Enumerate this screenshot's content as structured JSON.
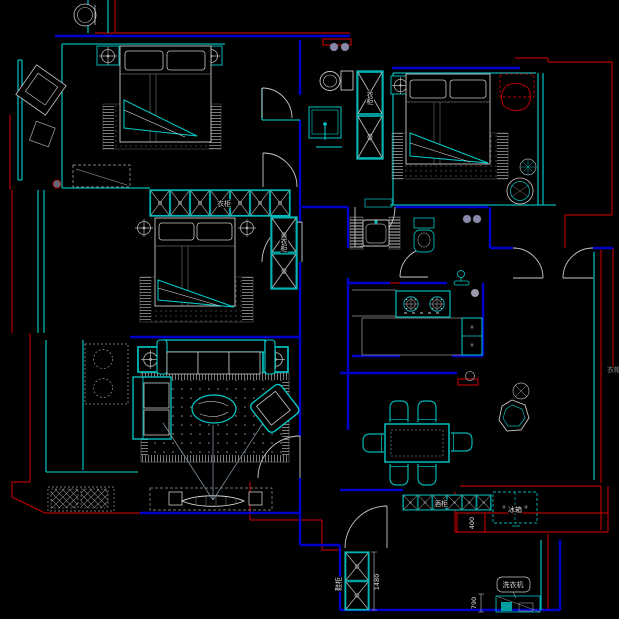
{
  "drawing": {
    "type": "residential-floor-plan",
    "colors": {
      "background": "#000000",
      "wall_red": "#b40000",
      "wall_blue": "#0000cc",
      "window_cyan": "#00b4b4",
      "furniture_cyan": "#00cccc",
      "furniture_gray": "#b8b8b8",
      "furniture_white": "#d8d8d8"
    },
    "labels": {
      "wardrobe_a": "衣柜",
      "wardrobe_b": "衣柜",
      "wardrobe_c": "衣柜",
      "wine_cabinet": "酒柜",
      "fridge": "冰箱",
      "shoe_cabinet": "鞋柜",
      "washing_machine": "洗衣机",
      "cloakroom": "衣帽"
    },
    "dimensions": {
      "d400": "400",
      "d1480": "1480",
      "d790": "790"
    }
  }
}
